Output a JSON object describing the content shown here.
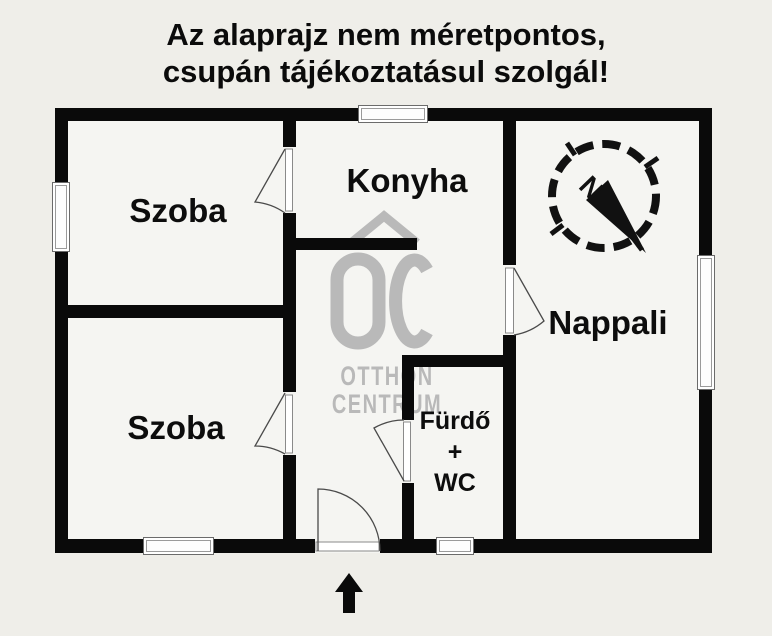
{
  "title": {
    "line1": "Az alaprajz nem méretpontos,",
    "line2": "csupán tájékoztatásul szolgál!"
  },
  "rooms": {
    "szoba_top": "Szoba",
    "konyha": "Konyha",
    "nappali": "Nappali",
    "szoba_bottom": "Szoba",
    "bathroom_line1": "Fürdő",
    "bathroom_line2": "+",
    "bathroom_line3": "WC"
  },
  "watermark": {
    "line1": "OTTHON",
    "line2": "CENTRUM"
  },
  "compass": {
    "north_label": "N"
  },
  "colors": {
    "background": "#efeee9",
    "room_fill": "#f5f5f2",
    "wall": "#0a0a0a",
    "watermark_gray": "#b9b9b9",
    "text": "#0b0b0b"
  }
}
